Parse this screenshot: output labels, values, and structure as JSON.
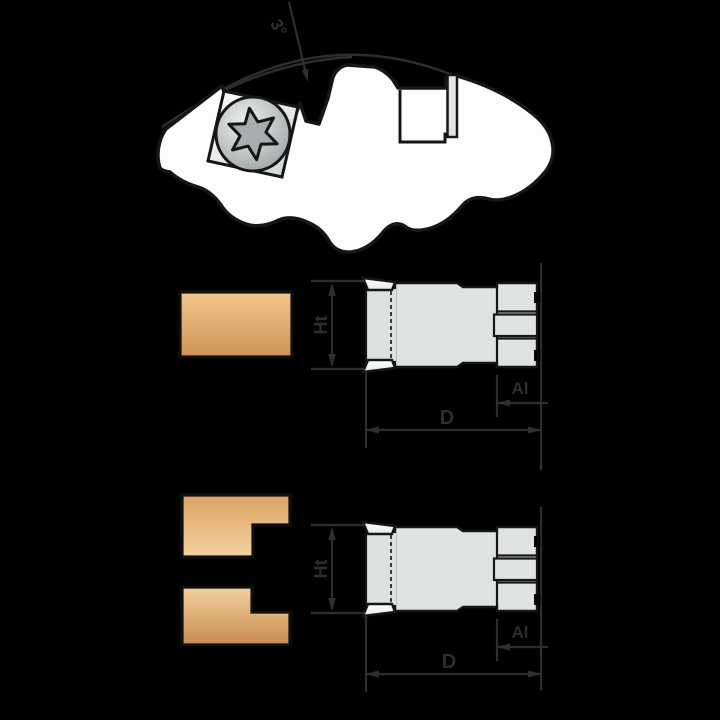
{
  "diagram": "insert-cutterhead-technical-drawing",
  "colors": {
    "background": "#000000",
    "dimension_lines": "#2e2e2e",
    "outline": "#161616",
    "steel_body": "#e0e3e4",
    "steel_screw": "#a9adaf",
    "insert_face_light": "#ffffff",
    "insert_face_dark": "#cfd3d4",
    "wood_light": "#f3d2a0",
    "wood_dark": "#cd9254"
  },
  "top_view": {
    "angle_label": "3°"
  },
  "middle_section": {
    "height_label": "Ht",
    "insert_width_label": "Al",
    "diameter_label": "D"
  },
  "bottom_section": {
    "height_label": "Ht",
    "insert_width_label": "Al",
    "diameter_label": "D"
  }
}
